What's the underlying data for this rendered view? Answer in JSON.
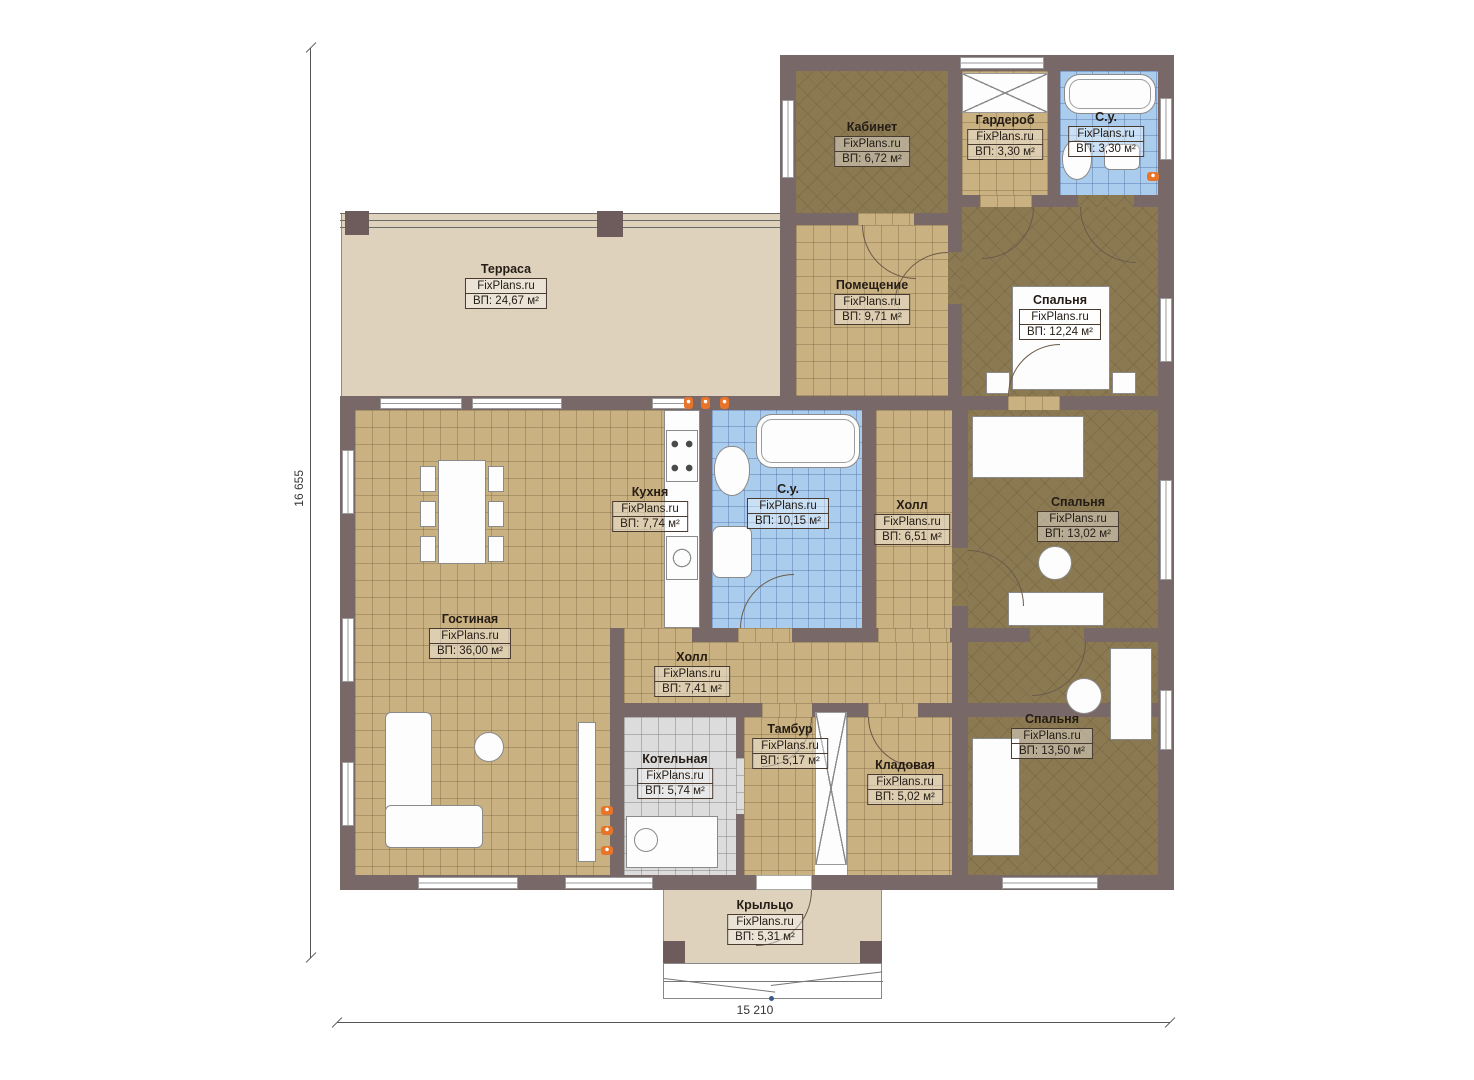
{
  "brand": "FixPlans.ru",
  "plan_title": "Floor plan",
  "dimensions": {
    "height": "16 655",
    "width": "15 210"
  },
  "rooms": [
    {
      "name": "Кабинет",
      "area": "ВП: 6,72 м²"
    },
    {
      "name": "Гардероб",
      "area": "ВП: 3,30 м²"
    },
    {
      "name": "С.у.",
      "area": "ВП: 3,30 м²"
    },
    {
      "name": "Терраса",
      "area": "ВП: 24,67 м²"
    },
    {
      "name": "Помещение",
      "area": "ВП: 9,71 м²"
    },
    {
      "name": "Спальня",
      "area": "ВП: 12,24 м²"
    },
    {
      "name": "Кухня",
      "area": "ВП: 7,74 м²"
    },
    {
      "name": "С.у.",
      "area": "ВП: 10,15 м²"
    },
    {
      "name": "Холл",
      "area": "ВП: 6,51 м²"
    },
    {
      "name": "Спальня",
      "area": "ВП: 13,02 м²"
    },
    {
      "name": "Гостиная",
      "area": "ВП: 36,00 м²"
    },
    {
      "name": "Холл",
      "area": "ВП: 7,41 м²"
    },
    {
      "name": "Тамбур",
      "area": "ВП: 5,17 м²"
    },
    {
      "name": "Котельная",
      "area": "ВП: 5,74 м²"
    },
    {
      "name": "Кладовая",
      "area": "ВП: 5,02 м²"
    },
    {
      "name": "Спальня",
      "area": "ВП: 13,50 м²"
    },
    {
      "name": "Крыльцо",
      "area": "ВП: 5,31 м²"
    }
  ],
  "colors": {
    "wall": "#796868",
    "floor_tile": "#c9b181",
    "floor_dark": "#8b7952",
    "floor_blue": "#aacdee",
    "floor_gray": "#dcdcdc",
    "terrace": "#ded2bd",
    "radiator": "#e8742a"
  }
}
